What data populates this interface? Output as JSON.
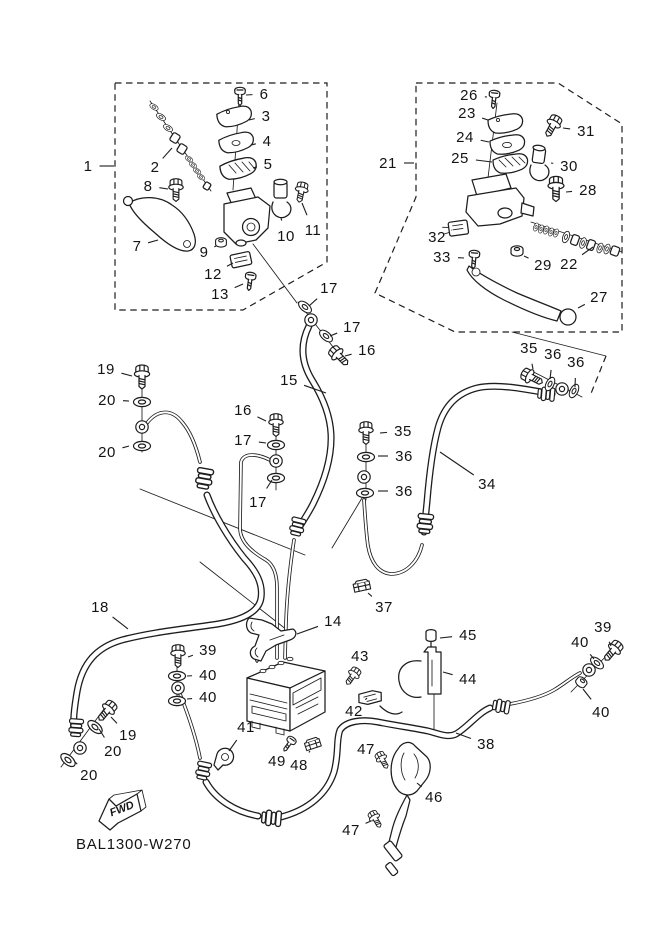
{
  "diagram": {
    "code": "BAL1300-W270",
    "fwd_label": "FWD",
    "ink_color": "#1d1d1d",
    "background_color": "#ffffff",
    "callouts": [
      {
        "n": "1",
        "x": 88,
        "y": 166,
        "tx": 114,
        "ty": 166
      },
      {
        "n": "2",
        "x": 155,
        "y": 167,
        "tx": 172,
        "ty": 148
      },
      {
        "n": "3",
        "x": 266,
        "y": 116,
        "tx": 249,
        "ty": 120
      },
      {
        "n": "4",
        "x": 267,
        "y": 141,
        "tx": 251,
        "ty": 145
      },
      {
        "n": "5",
        "x": 268,
        "y": 164,
        "tx": 253,
        "ty": 168
      },
      {
        "n": "6",
        "x": 264,
        "y": 94,
        "tx": 246,
        "ty": 95
      },
      {
        "n": "7",
        "x": 137,
        "y": 246,
        "tx": 158,
        "ty": 240
      },
      {
        "n": "8",
        "x": 148,
        "y": 186,
        "tx": 168,
        "ty": 189
      },
      {
        "n": "9",
        "x": 204,
        "y": 252,
        "tx": 216,
        "ty": 246
      },
      {
        "n": "10",
        "x": 286,
        "y": 236,
        "tx": 281,
        "ty": 218
      },
      {
        "n": "11",
        "x": 313,
        "y": 230,
        "tx": 302,
        "ty": 203
      },
      {
        "n": "12",
        "x": 213,
        "y": 274,
        "tx": 233,
        "ty": 263
      },
      {
        "n": "13",
        "x": 220,
        "y": 294,
        "tx": 243,
        "ty": 284
      },
      {
        "n": "17",
        "x": 329,
        "y": 288,
        "tx": 309,
        "ty": 306
      },
      {
        "n": "17",
        "x": 352,
        "y": 327,
        "tx": 330,
        "ty": 336
      },
      {
        "n": "16",
        "x": 367,
        "y": 350,
        "tx": 345,
        "ty": 356
      },
      {
        "n": "21",
        "x": 388,
        "y": 163,
        "tx": 414,
        "ty": 163
      },
      {
        "n": "26",
        "x": 469,
        "y": 95,
        "tx": 487,
        "ty": 97
      },
      {
        "n": "23",
        "x": 467,
        "y": 113,
        "tx": 488,
        "ty": 120
      },
      {
        "n": "24",
        "x": 465,
        "y": 137,
        "tx": 489,
        "ty": 142
      },
      {
        "n": "25",
        "x": 460,
        "y": 158,
        "tx": 492,
        "ty": 162
      },
      {
        "n": "31",
        "x": 586,
        "y": 131,
        "tx": 563,
        "ty": 128
      },
      {
        "n": "30",
        "x": 569,
        "y": 166,
        "tx": 551,
        "ty": 163
      },
      {
        "n": "28",
        "x": 588,
        "y": 190,
        "tx": 566,
        "ty": 192
      },
      {
        "n": "32",
        "x": 437,
        "y": 237,
        "tx": 452,
        "ty": 230
      },
      {
        "n": "33",
        "x": 442,
        "y": 257,
        "tx": 464,
        "ty": 258
      },
      {
        "n": "29",
        "x": 543,
        "y": 265,
        "tx": 524,
        "ty": 256
      },
      {
        "n": "22",
        "x": 569,
        "y": 264,
        "tx": 593,
        "ty": 247
      },
      {
        "n": "27",
        "x": 599,
        "y": 297,
        "tx": 578,
        "ty": 308
      },
      {
        "n": "15",
        "x": 289,
        "y": 380,
        "tx": 326,
        "ty": 393
      },
      {
        "n": "19",
        "x": 106,
        "y": 369,
        "tx": 132,
        "ty": 376
      },
      {
        "n": "20",
        "x": 107,
        "y": 400,
        "tx": 129,
        "ty": 401
      },
      {
        "n": "20",
        "x": 107,
        "y": 452,
        "tx": 129,
        "ty": 446
      },
      {
        "n": "16",
        "x": 243,
        "y": 410,
        "tx": 266,
        "ty": 421
      },
      {
        "n": "17",
        "x": 243,
        "y": 440,
        "tx": 266,
        "ty": 443
      },
      {
        "n": "17",
        "x": 258,
        "y": 502,
        "tx": 272,
        "ty": 480
      },
      {
        "n": "35",
        "x": 529,
        "y": 348,
        "tx": 533,
        "ty": 369
      },
      {
        "n": "36",
        "x": 553,
        "y": 354,
        "tx": 550,
        "ty": 379
      },
      {
        "n": "36",
        "x": 576,
        "y": 362,
        "tx": 575,
        "ty": 387
      },
      {
        "n": "35",
        "x": 403,
        "y": 431,
        "tx": 380,
        "ty": 433
      },
      {
        "n": "36",
        "x": 404,
        "y": 456,
        "tx": 378,
        "ty": 456
      },
      {
        "n": "36",
        "x": 404,
        "y": 491,
        "tx": 378,
        "ty": 491
      },
      {
        "n": "34",
        "x": 487,
        "y": 484,
        "tx": 440,
        "ty": 452
      },
      {
        "n": "18",
        "x": 100,
        "y": 607,
        "tx": 128,
        "ty": 629
      },
      {
        "n": "37",
        "x": 384,
        "y": 607,
        "tx": 368,
        "ty": 593
      },
      {
        "n": "14",
        "x": 333,
        "y": 621,
        "tx": 297,
        "ty": 634
      },
      {
        "n": "39",
        "x": 208,
        "y": 650,
        "tx": 188,
        "ty": 657
      },
      {
        "n": "40",
        "x": 208,
        "y": 675,
        "tx": 187,
        "ty": 676
      },
      {
        "n": "40",
        "x": 208,
        "y": 697,
        "tx": 187,
        "ty": 699
      },
      {
        "n": "45",
        "x": 468,
        "y": 635,
        "tx": 440,
        "ty": 638
      },
      {
        "n": "44",
        "x": 468,
        "y": 679,
        "tx": 443,
        "ty": 672
      },
      {
        "n": "43",
        "x": 360,
        "y": 656,
        "tx": 353,
        "ty": 671
      },
      {
        "n": "42",
        "x": 354,
        "y": 711,
        "tx": 367,
        "ty": 698
      },
      {
        "n": "39",
        "x": 603,
        "y": 627,
        "tx": 611,
        "ty": 646
      },
      {
        "n": "40",
        "x": 580,
        "y": 642,
        "tx": 594,
        "ty": 659
      },
      {
        "n": "40",
        "x": 601,
        "y": 712,
        "tx": 583,
        "ty": 689
      },
      {
        "n": "38",
        "x": 486,
        "y": 744,
        "tx": 456,
        "ty": 733
      },
      {
        "n": "19",
        "x": 128,
        "y": 735,
        "tx": 111,
        "ty": 717
      },
      {
        "n": "20",
        "x": 113,
        "y": 751,
        "tx": 99,
        "ty": 729
      },
      {
        "n": "20",
        "x": 89,
        "y": 775,
        "tx": 75,
        "ty": 762
      },
      {
        "n": "41",
        "x": 246,
        "y": 727,
        "tx": 229,
        "ty": 751
      },
      {
        "n": "49",
        "x": 277,
        "y": 761,
        "tx": 287,
        "ty": 749
      },
      {
        "n": "48",
        "x": 299,
        "y": 765,
        "tx": 310,
        "ty": 751
      },
      {
        "n": "47",
        "x": 366,
        "y": 749,
        "tx": 380,
        "ty": 759
      },
      {
        "n": "46",
        "x": 434,
        "y": 797,
        "tx": 417,
        "ty": 783
      },
      {
        "n": "47",
        "x": 351,
        "y": 830,
        "tx": 371,
        "ty": 821
      }
    ]
  }
}
